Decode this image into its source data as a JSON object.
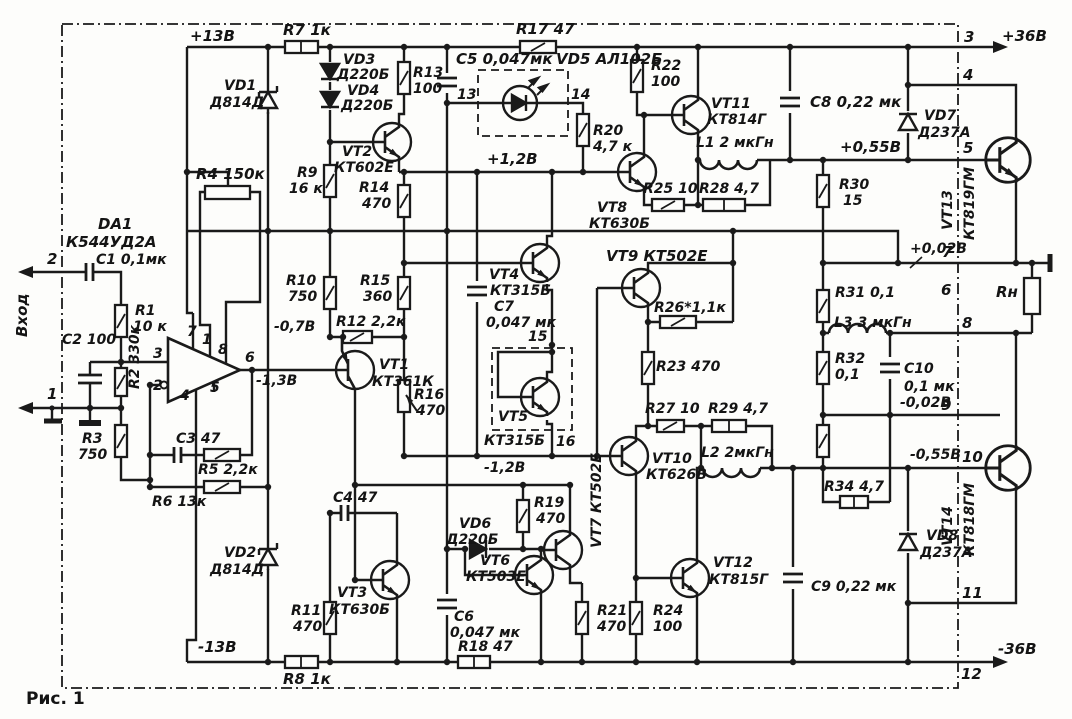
{
  "colors": {
    "ink": "#1a1a1a",
    "paper": "#fdfdfb"
  },
  "t": {
    "p13": "+13В",
    "m13": "-13В",
    "p36": "+36В",
    "m36": "-36В",
    "p12": "+1,2В",
    "m12": "-1,2В",
    "m07": "-0,7В",
    "m13a": "-1,3В",
    "p055": "+0,55В",
    "m055": "-0,55В",
    "p002": "+0,02В",
    "m002": "-0,02В",
    "r1a": "R1",
    "r1b": "10 к",
    "r2": "R2 330к",
    "r3a": "R3",
    "r3b": "750",
    "r4": "R4 150к",
    "r5": "R5 2,2к",
    "r6": "R6 13к",
    "r7": "R7 1к",
    "r8": "R8 1к",
    "r9a": "R9",
    "r9b": "16 к",
    "r10a": "R10",
    "r10b": "750",
    "r11a": "R11",
    "r11b": "470",
    "r12": "R12 2,2к",
    "r13a": "R13",
    "r13b": "100",
    "r14a": "R14",
    "r14b": "470",
    "r15a": "R15",
    "r15b": "360",
    "r16a": "R16",
    "r16b": "470",
    "r17": "R17 47",
    "r18": "R18 47",
    "r19a": "R19",
    "r19b": "470",
    "r20a": "R20",
    "r20b": "4,7 к",
    "r21a": "R21",
    "r21b": "470",
    "r22a": "R22",
    "r22b": "100",
    "r23": "R23 470",
    "r24a": "R24",
    "r24b": "100",
    "r25": "R25 10",
    "r26": "R26*1,1к",
    "r27": "R27 10",
    "r28": "R28 4,7",
    "r29": "R29 4,7",
    "r30a": "R30",
    "r30b": "15",
    "r31": "R31 0,1",
    "r32a": "R32",
    "r32b": "0,1",
    "r33a": "R33",
    "r33b": "15",
    "r34": "R34 4,7",
    "rn": "Rн",
    "c1": "C1 0,1мк",
    "c2": "C2 100",
    "c3": "C3 47",
    "c4": "C4 47",
    "c5": "C5 0,047мк",
    "c6a": "C6",
    "c6b": "0,047 мк",
    "c7a": "C7",
    "c7b": "0,047 мк",
    "c8": "C8 0,22 мк",
    "c9": "C9 0,22 мк",
    "c10a": "C10",
    "c10b": "0,1 мк",
    "vd1a": "VD1",
    "vd1b": "Д814Д",
    "vd2a": "VD2",
    "vd2b": "Д814Д",
    "vd3a": "VD3",
    "vd3b": "Д220Б",
    "vd4a": "VD4",
    "vd4b": "Д220Б",
    "vd5": "VD5 АЛ102Б",
    "vd6a": "VD6",
    "vd6b": "Д220Б",
    "vd7a": "VD7",
    "vd7b": "Д237А",
    "vd8a": "VD8",
    "vd8b": "Д237А",
    "vt1a": "VT1",
    "vt1b": "КТ361К",
    "vt2a": "VT2",
    "vt2b": "КТ602Е",
    "vt3a": "VT3",
    "vt3b": "КТ630Б",
    "vt4a": "VT4",
    "vt4b": "КТ315Б",
    "vt5a": "VT5",
    "vt5b": "КТ315Б",
    "vt6a": "VT6",
    "vt6b": "КТ503Е",
    "vt7": "VT7 КТ502Е",
    "vt8a": "VT8",
    "vt8b": "КТ630Б",
    "vt9": "VT9 КТ502Е",
    "vt10a": "VT10",
    "vt10b": "КТ626В",
    "vt11a": "VT11",
    "vt11b": "КТ814Г",
    "vt12a": "VT12",
    "vt12b": "КТ815Г",
    "vt13a": "VT13",
    "vt13b": "КТ819ГМ",
    "vt14a": "VT14",
    "vt14b": "КТ818ГМ",
    "l1": "L1 2 мкГн",
    "l2": "L2 2мкГн",
    "l3": "L3 3 мкГн",
    "da1a": "DA1",
    "da1b": "К544УД2А",
    "vhod": "Вход",
    "fig": "Рис. 1",
    "n1": "1",
    "n2": "2",
    "n3": "3",
    "n4": "4",
    "n5": "5",
    "n6": "6",
    "n7": "7",
    "n8": "8",
    "n9": "9",
    "n10": "10",
    "n11": "11",
    "n12": "12",
    "n13": "13",
    "n14": "14",
    "n15": "15",
    "n16": "16",
    "o1": "1",
    "o2": "2",
    "o3": "3",
    "o4": "4",
    "o5": "5",
    "o6": "6",
    "o7": "7",
    "o8": "8"
  }
}
